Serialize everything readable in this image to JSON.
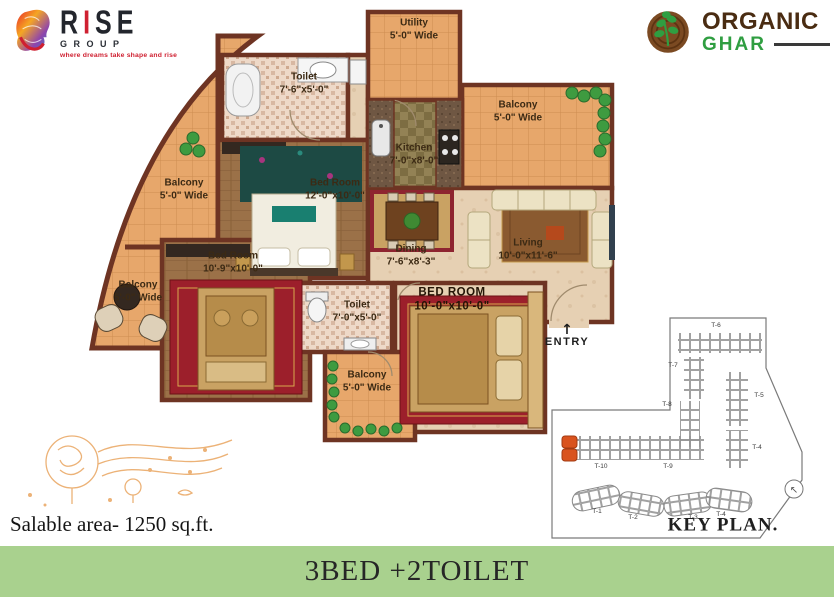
{
  "logos": {
    "rise": {
      "part1": "R",
      "part2": "I",
      "part3": "SE",
      "subtitle": "GROUP",
      "tagline": "where dreams take shape and rise"
    },
    "organic_ghar": {
      "line1": "ORGANIC",
      "line2": "GHAR"
    }
  },
  "floorplan": {
    "entry_label": "ENTRY",
    "rooms": [
      {
        "name": "Utility",
        "dims": "5'-0\" Wide"
      },
      {
        "name": "Toilet",
        "dims": "7'-6\"x5'-0\""
      },
      {
        "name": "Bed Room",
        "dims": "12'-0\"x10'-0\""
      },
      {
        "name": "Kitchen",
        "dims": "7'-0\"x8'-0\""
      },
      {
        "name": "Balcony",
        "dims": "5'-0\" Wide"
      },
      {
        "name": "Living",
        "dims": "10'-0\"x11'-6\""
      },
      {
        "name": "Dining",
        "dims": "7'-6\"x8'-3\""
      },
      {
        "name": "Balcony",
        "dims": "5'-0\" Wide"
      },
      {
        "name": "Balcony",
        "dims": "5'-0\" Wide"
      },
      {
        "name": "Bed Room",
        "dims": "10'-9\"x10'-0\""
      },
      {
        "name": "Toilet",
        "dims": "7'-0\"x5'-0\""
      },
      {
        "name": "BED ROOM",
        "dims": "10'-0\"x10'-0\""
      },
      {
        "name": "Balcony",
        "dims": "5'-0\" Wide"
      }
    ]
  },
  "keyplan": {
    "title": "KEY PLAN.",
    "towers": {
      "t1": "T-1",
      "t2": "T-2",
      "t3": "T-3",
      "t4_bottom": "T-4",
      "t4_right": "T-4",
      "t5": "T-5",
      "t6": "T-6",
      "t7": "T-7",
      "t8": "T-8",
      "t9": "T-9",
      "t10": "T-10"
    }
  },
  "footer": {
    "salable_area": "Salable area- 1250 sq.ft.",
    "banner_title": "3BED +2TOILET"
  },
  "colors": {
    "banner_bg": "#a9d18e",
    "accent_red": "#cf2031",
    "ghar_green": "#2f9e41",
    "wall_brown": "#6e3423"
  }
}
